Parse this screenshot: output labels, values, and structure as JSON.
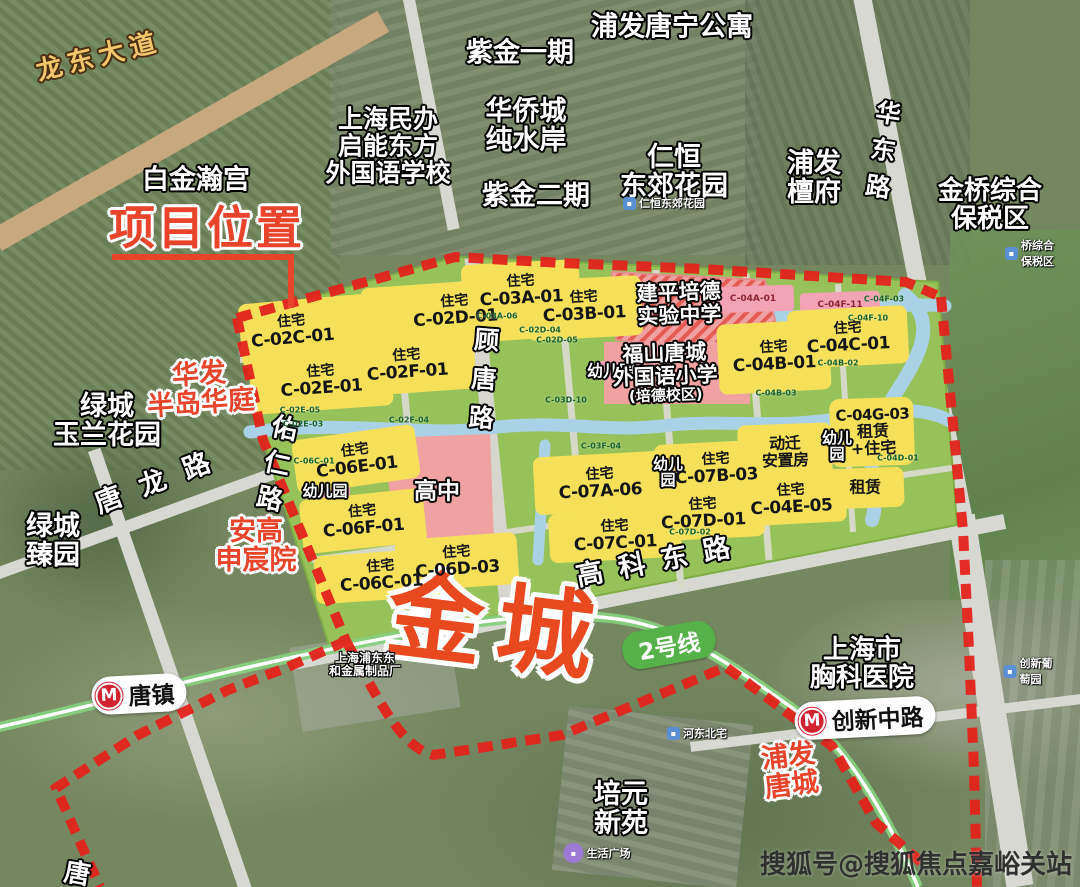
{
  "marker": {
    "title": "项目位置",
    "project_name": "金城"
  },
  "roads": {
    "longdong": "龙东大道",
    "tanglong": "唐龙路",
    "youren": "佑仁路",
    "gutang": "顾唐路",
    "huadong": "华东路",
    "gaokedong": "高科东路",
    "tang_edge": "唐"
  },
  "metro": {
    "line_badge": "2号线",
    "station_tangzhen": "唐镇",
    "station_chuangxin": "创新中路",
    "logo_letter": "M"
  },
  "places": [
    {
      "l1": "白金瀚宫"
    },
    {
      "l1": "上海民办",
      "l2": "启能东方",
      "l3": "外国语学校"
    },
    {
      "l1": "紫金一期"
    },
    {
      "l1": "华侨城",
      "l2": "纯水岸"
    },
    {
      "l1": "紫金二期"
    },
    {
      "l1": "浦发唐宁公寓"
    },
    {
      "l1": "仁恒",
      "l2": "东郊花园"
    },
    {
      "l1": "浦发",
      "l2": "檀府"
    },
    {
      "l1": "金桥综合",
      "l2": "保税区"
    },
    {
      "l1": "绿城",
      "l2": "玉兰花园"
    },
    {
      "l1": "华发",
      "l2": "半岛华庭"
    },
    {
      "l1": "绿城",
      "l2": "臻园"
    },
    {
      "l1": "安高",
      "l2": "申宸院"
    },
    {
      "l1": "上海浦东东",
      "l2": "和金属制品厂"
    },
    {
      "l1": "上海市",
      "l2": "胸科医院"
    },
    {
      "l1": "浦发",
      "l2": "唐城"
    },
    {
      "l1": "培元",
      "l2": "新苑"
    }
  ],
  "plan_labels": [
    {
      "l1": "住宅",
      "l2": "C-02C-01"
    },
    {
      "l1": "住宅",
      "l2": "C-02D-01"
    },
    {
      "l1": "住宅",
      "l2": "C-02E-01"
    },
    {
      "l1": "住宅",
      "l2": "C-02F-01"
    },
    {
      "l1": "住宅",
      "l2": "C-03A-01"
    },
    {
      "l1": "住宅",
      "l2": "C-03B-01"
    },
    {
      "l1": "建平培德",
      "l2": "实验中学"
    },
    {
      "l1": "幼儿园"
    },
    {
      "l1": "福山唐城",
      "l2": "外国语小学",
      "l3": "(培德校区)"
    },
    {
      "l1": "住宅",
      "l2": "C-04B-01"
    },
    {
      "l1": "住宅",
      "l2": "C-04C-01"
    },
    {
      "l1": "C-04G-03",
      "l2": "租赁",
      "l3": "+住宅"
    },
    {
      "l1": "幼儿",
      "l2": "园"
    },
    {
      "l1": "动迁",
      "l2": "安置房"
    },
    {
      "l1": "租赁"
    },
    {
      "l1": "住宅",
      "l2": "C-04E-05"
    },
    {
      "l1": "住宅",
      "l2": "C-06E-01"
    },
    {
      "l1": "幼儿园"
    },
    {
      "l1": "高中"
    },
    {
      "l1": "住宅",
      "l2": "C-06F-01"
    },
    {
      "l1": "住宅",
      "l2": "C-06C-01"
    },
    {
      "l1": "住宅",
      "l2": "C-06D-03"
    },
    {
      "l1": "住宅",
      "l2": "C-07A-06"
    },
    {
      "l1": "幼儿",
      "l2": "园"
    },
    {
      "l1": "住宅",
      "l2": "C-07B-03"
    },
    {
      "l1": "住宅",
      "l2": "C-07C-01"
    },
    {
      "l1": "住宅",
      "l2": "C-07D-01"
    }
  ],
  "pois": [
    {
      "name": "仁恒东郊花园"
    },
    {
      "name": "桥综合保税区"
    },
    {
      "name": "河东北宅"
    },
    {
      "name": "创新葡萄园"
    },
    {
      "name": "生活广场"
    }
  ],
  "tiny_codes": [
    "C-03A-06",
    "C-02D-04",
    "C-02D-05",
    "C-02E-05",
    "C-02E-03",
    "C-02F-04",
    "C-03D-10",
    "C-03F-04",
    "C-04F-10",
    "C-04F-03",
    "C-04B-02",
    "C-04B-03",
    "C-04D-01",
    "C-06C-01",
    "C-07D-02"
  ],
  "pink_codes": [
    "C-04A-01",
    "C-04F-11"
  ],
  "watermark": "搜狐号@搜狐焦点嘉峪关站",
  "colors": {
    "boundary_red": "#e3231c",
    "parcel_yellow": "#f6e05a",
    "plan_green": "#97c25a",
    "water_blue": "#aad2e6",
    "school_pink": "#f0a1a1",
    "metro_green": "#57b14a",
    "accent_orange": "#e8432b",
    "road_tan": "#c8a87e"
  }
}
